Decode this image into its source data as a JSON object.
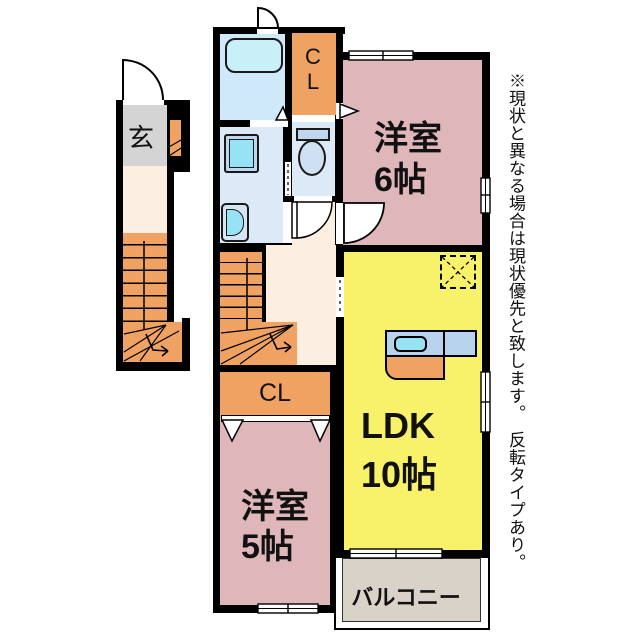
{
  "plan": {
    "labels": {
      "genkan": "玄",
      "closet_top": "CL",
      "closet_mid": "CL",
      "room6_name": "洋室",
      "room6_size": "6帖",
      "room5_name": "洋室",
      "room5_size": "5帖",
      "ldk_name": "LDK",
      "ldk_size": "10帖",
      "balcony": "バルコニー",
      "note": "※現状と異なる場合は現状優先と致します。　反転タイプあり。"
    },
    "colors": {
      "wall": "#000000",
      "pink": "#dfb6ba",
      "yellow": "#f8f16a",
      "orange": "#f0a263",
      "cream": "#fcefe2",
      "gray": "#d4d4d4",
      "balcony": "#d9d2c9",
      "bath": "#cfe8fa",
      "roomblue": "#dceaf7",
      "fixture": "#bed6ee",
      "cyan": "#97e2f4",
      "tub": "#c9eff9",
      "counter": "#b8d3ee"
    }
  }
}
